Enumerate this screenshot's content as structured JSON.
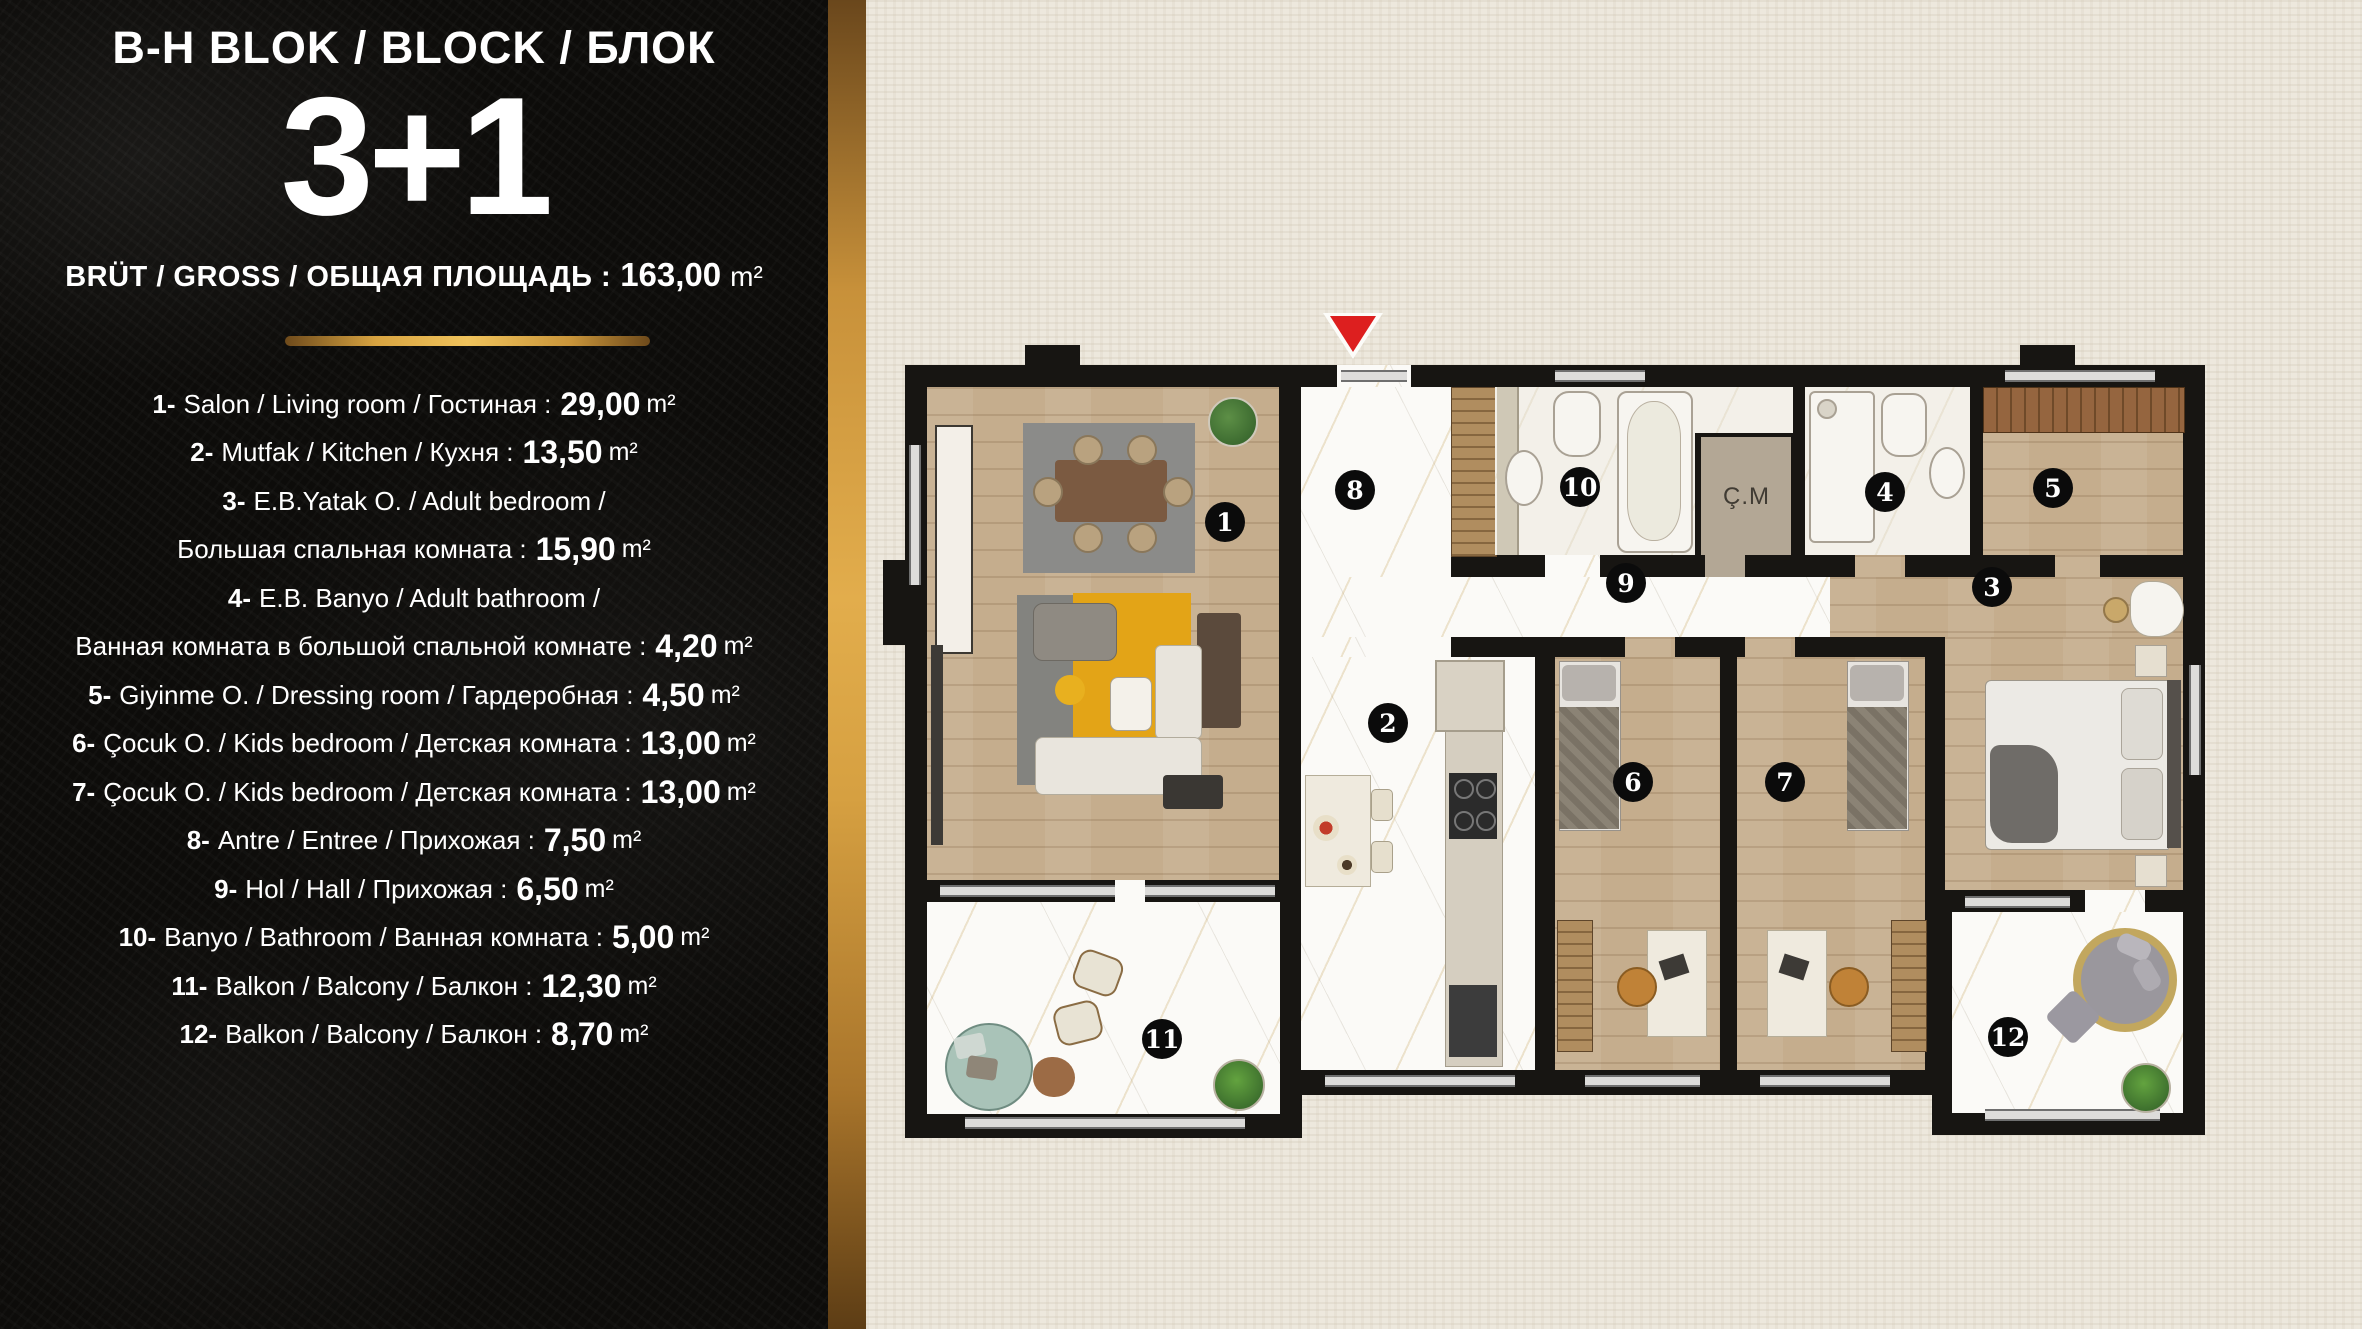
{
  "panel": {
    "title": "B-H BLOK / BLOCK / БЛОК",
    "type_label": "3+1",
    "gross_label": "BRÜT / GROSS / ОБЩАЯ ПЛОЩАДЬ :",
    "gross_value": "163,00",
    "unit": "m²",
    "rooms": [
      {
        "num": "1-",
        "name": "Salon / Living room / Гостиная :",
        "value": "29,00",
        "unit": "m²"
      },
      {
        "num": "2-",
        "name": "Mutfak / Kitchen / Кухня :",
        "value": "13,50",
        "unit": "m²"
      },
      {
        "num": "3-",
        "name": "E.B.Yatak O. / Adult bedroom /",
        "name2": "Большая спальная комната :",
        "value": "15,90",
        "unit": "m²"
      },
      {
        "num": "4-",
        "name": "E.B. Banyo / Adult bathroom /",
        "name2": "Ванная комната в большой спальной комнате :",
        "value": "4,20",
        "unit": "m²"
      },
      {
        "num": "5-",
        "name": "Giyinme O. / Dressing room / Гардеробная :",
        "value": "4,50",
        "unit": "m²"
      },
      {
        "num": "6-",
        "name": "Çocuk O. / Kids bedroom / Детская комната :",
        "value": "13,00",
        "unit": "m²"
      },
      {
        "num": "7-",
        "name": "Çocuk O. / Kids bedroom / Детская комната :",
        "value": "13,00",
        "unit": "m²"
      },
      {
        "num": "8-",
        "name": "Antre / Entree / Прихожая :",
        "value": "7,50",
        "unit": "m²"
      },
      {
        "num": "9-",
        "name": "Hol / Hall / Прихожая :",
        "value": "6,50",
        "unit": "m²"
      },
      {
        "num": "10-",
        "name": "Banyo / Bathroom / Ванная комната :",
        "value": "5,00",
        "unit": "m²"
      },
      {
        "num": "11-",
        "name": "Balkon / Balcony / Балкон :",
        "value": "12,30",
        "unit": "m²"
      },
      {
        "num": "12-",
        "name": "Balkon / Balcony / Балкон :",
        "value": "8,70",
        "unit": "m²"
      }
    ]
  },
  "plan": {
    "closet_label": "Ç.M",
    "markers": [
      {
        "n": "1"
      },
      {
        "n": "2"
      },
      {
        "n": "3"
      },
      {
        "n": "4"
      },
      {
        "n": "5"
      },
      {
        "n": "6"
      },
      {
        "n": "7"
      },
      {
        "n": "8"
      },
      {
        "n": "9"
      },
      {
        "n": "10"
      },
      {
        "n": "11"
      },
      {
        "n": "12"
      }
    ]
  },
  "colors": {
    "gold": "#d8a441",
    "entrance-red": "#dd1f1f",
    "wall": "#171512",
    "panel-bg": "#0d0c0a",
    "paper-beige": "#ede8dd"
  }
}
